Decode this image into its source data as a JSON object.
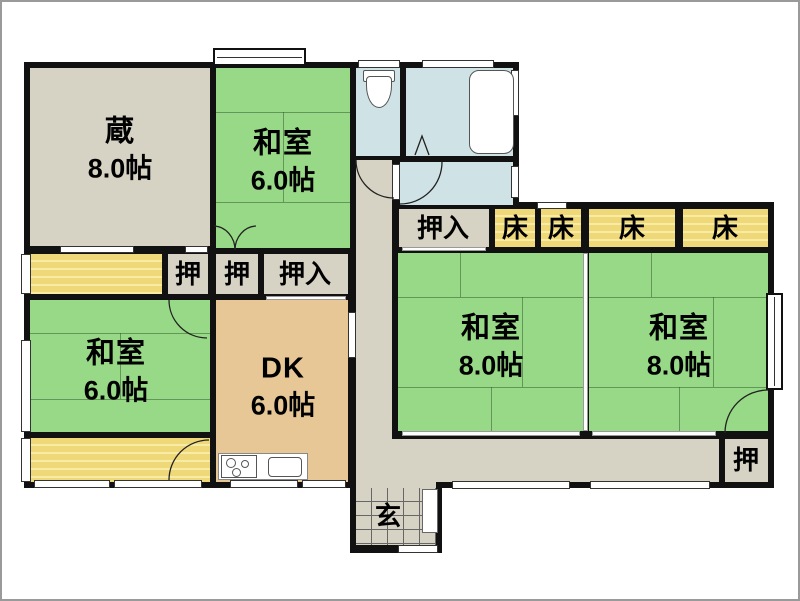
{
  "plan_title": "Japanese house floor plan",
  "colors": {
    "tatami_green": "#97d986",
    "tokonoma_yellow": "#eed878",
    "storage_gray": "#d6d2c4",
    "dk_tan": "#e6c795",
    "wet_area_blue": "#cfe3e6",
    "wall_black": "#111111"
  },
  "rooms": {
    "kura": {
      "name": "蔵",
      "size": "8.0帖"
    },
    "washitsu_top": {
      "name": "和室",
      "size": "6.0帖"
    },
    "washitsu_left": {
      "name": "和室",
      "size": "6.0帖"
    },
    "dk": {
      "name": "DK",
      "size": "6.0帖"
    },
    "washitsu8_left": {
      "name": "和室",
      "size": "8.0帖"
    },
    "washitsu8_right": {
      "name": "和室",
      "size": "8.0帖"
    },
    "genkan": {
      "name": "玄"
    }
  },
  "closets": {
    "oshi_1": "押",
    "oshi_2": "押",
    "oshiire_left": "押入",
    "oshiire_right": "押入",
    "oshi_bottom": "押"
  },
  "tokonoma": [
    "床",
    "床",
    "床",
    "床"
  ]
}
